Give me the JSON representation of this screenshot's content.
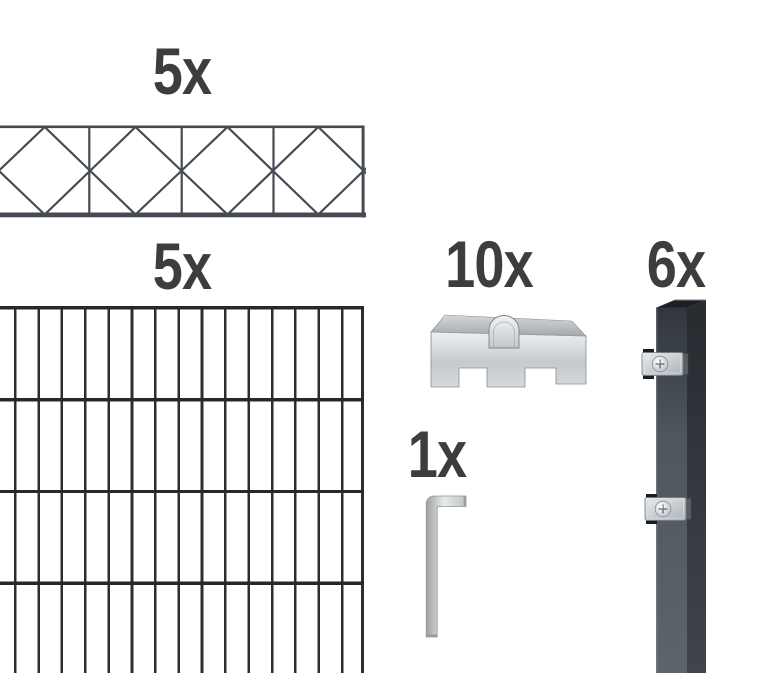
{
  "page": {
    "background": "#ffffff"
  },
  "items": {
    "topper_panel": {
      "qty_label": "5x"
    },
    "mesh_panel": {
      "qty_label": "5x"
    },
    "connector_clamps": {
      "qty_label": "10x"
    },
    "hex_key": {
      "qty_label": "1x"
    },
    "posts": {
      "qty_label": "6x"
    }
  },
  "colors": {
    "page_bg": "#ffffff",
    "label": "#3d3d3e",
    "wire_slate": "#464b53",
    "wire_dark": "#2a2d31",
    "rail_dark": "#25282c",
    "steel_light": "#eceeef",
    "steel_mid": "#b9bec1",
    "steel_dark": "#878d91",
    "anthracite_front": "#4f565d",
    "anthracite_side": "#2c3136",
    "anthracite_cap": "#1c2024",
    "clamp_slot": "#191d20"
  }
}
